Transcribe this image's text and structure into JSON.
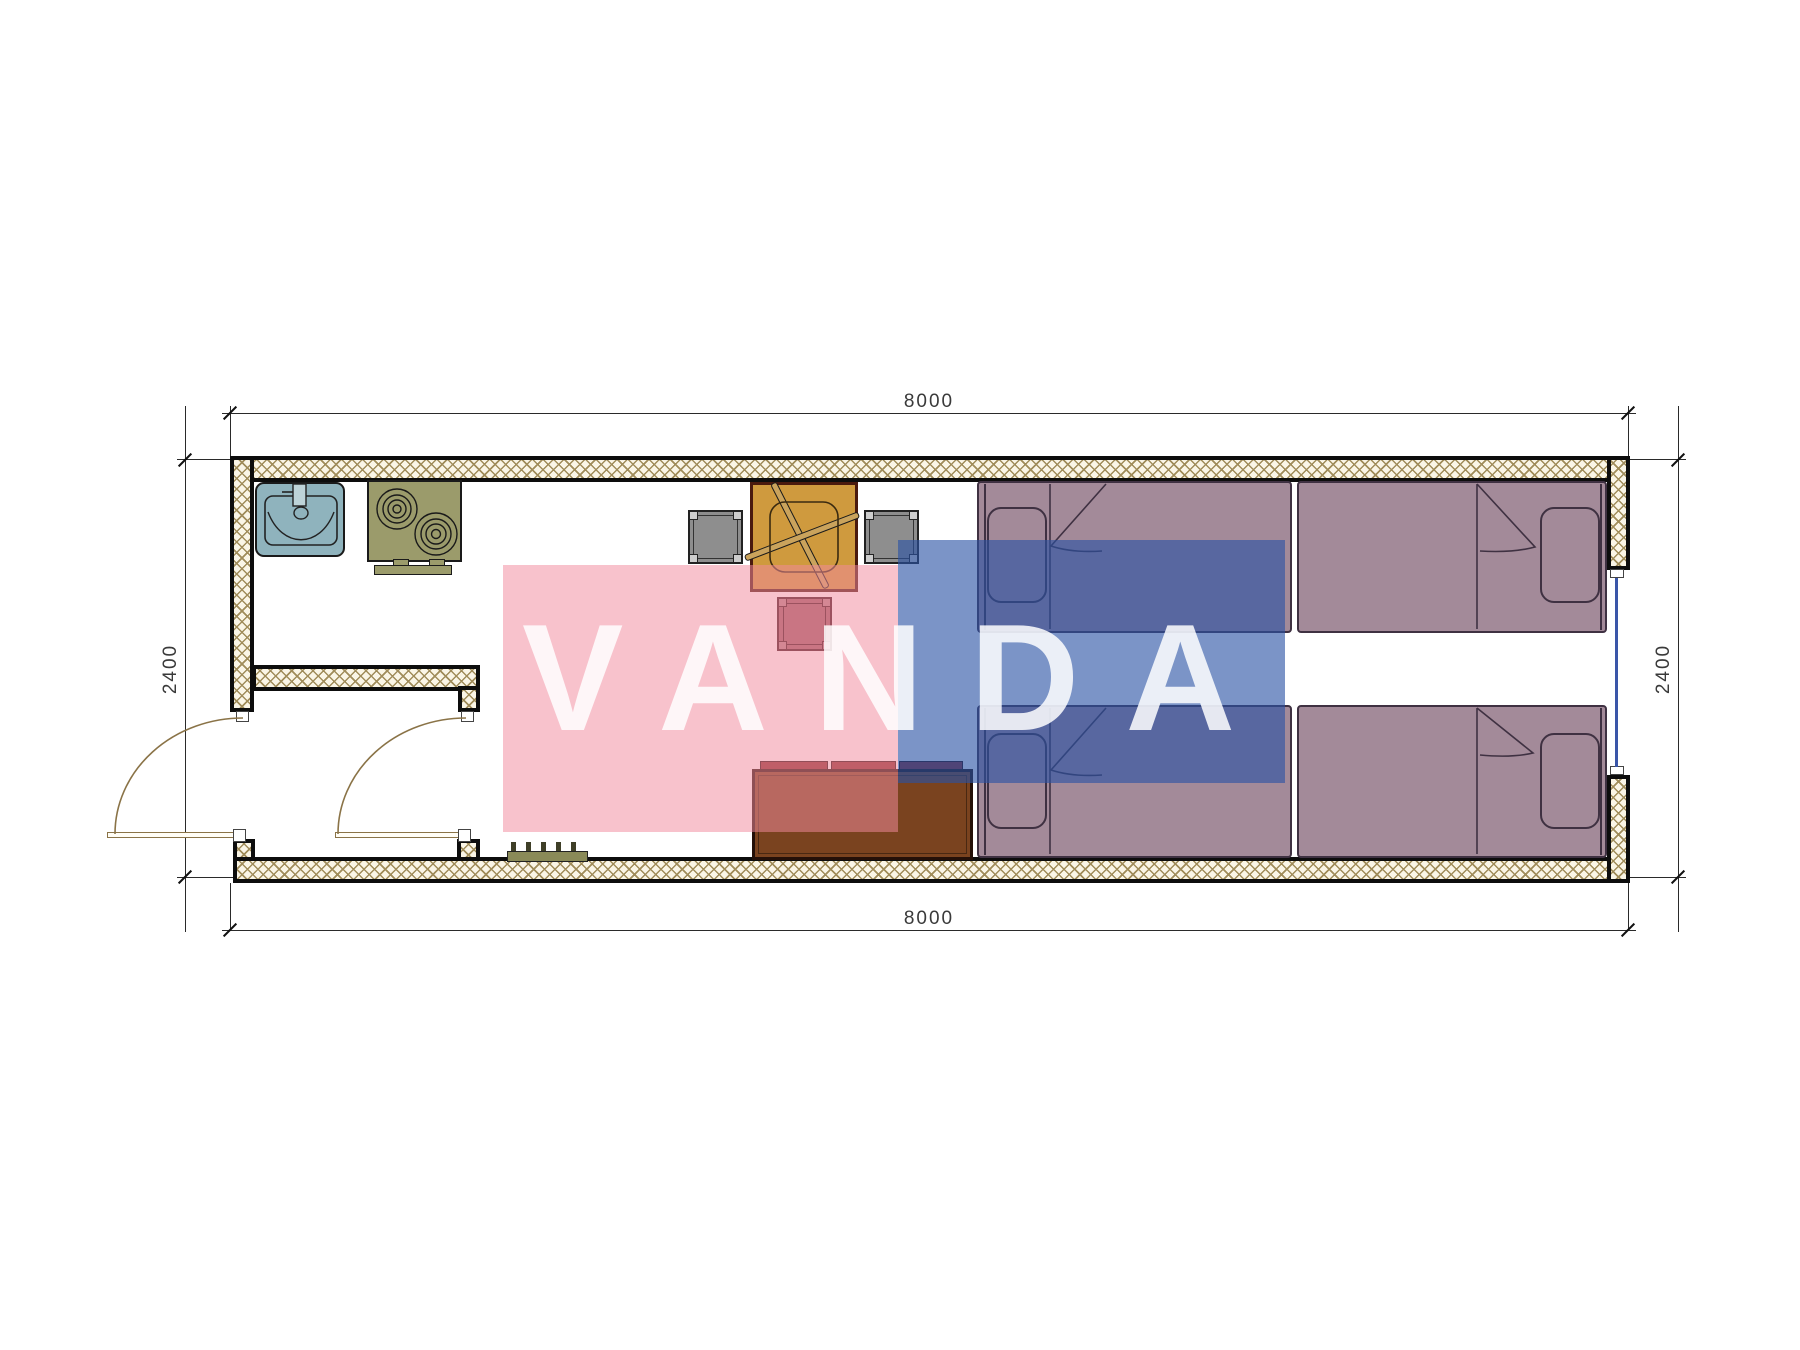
{
  "title": "Container house floor plan 8000x2400 with furniture layout",
  "dimensions": {
    "top": "8000",
    "bottom": "8000",
    "left": "2400",
    "right": "2400"
  },
  "watermark": {
    "text": "VANDA",
    "pink_color": "#f28aa0",
    "blue_color": "#2a52a5",
    "text_color": "#ffffff"
  },
  "colors": {
    "wall_hatch": "#a08c5a",
    "wall_fill": "#faf5e6",
    "wall_outline": "#0d0d0d",
    "dimension_lines": "#2a2a2a",
    "sink": "#8fb3bd",
    "stove": "#9b9b6b",
    "dining_table": "#cf9a3e",
    "chair": "#8e8e8e",
    "side_table": "#9e5f68",
    "sofa": "#7a431f",
    "sofa_cushion": "#8b2f2f",
    "bed": "#a38a99",
    "window_glazing": "#3a56a8",
    "door_swing": "#8a7347",
    "floor_grate": "#8a8a58"
  },
  "furniture": [
    {
      "name": "sink",
      "area": "kitchen, top-left"
    },
    {
      "name": "two-burner-stove",
      "area": "kitchen, top-left"
    },
    {
      "name": "dining-table-with-crossed-utensils",
      "area": "center"
    },
    {
      "name": "chair-left",
      "area": "center"
    },
    {
      "name": "chair-right",
      "area": "center"
    },
    {
      "name": "side-table",
      "area": "center"
    },
    {
      "name": "sofa-three-cushions",
      "area": "bottom center"
    },
    {
      "name": "bed-top-left",
      "pillow": "left"
    },
    {
      "name": "bed-top-right",
      "pillow": "right"
    },
    {
      "name": "bed-bottom-left",
      "pillow": "left"
    },
    {
      "name": "bed-bottom-right",
      "pillow": "right"
    }
  ],
  "openings": [
    {
      "name": "entry-door-left",
      "state": "open 90deg"
    },
    {
      "name": "interior-door-right",
      "state": "open 90deg"
    },
    {
      "name": "window-right-wall",
      "glazing": "blue line"
    }
  ]
}
